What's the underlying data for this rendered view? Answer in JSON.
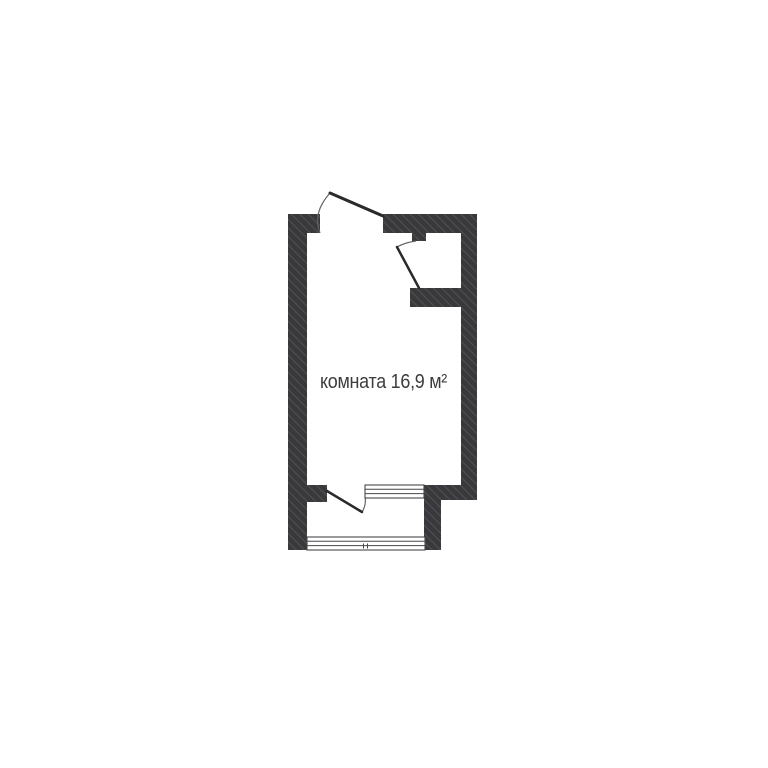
{
  "canvas": {
    "width": 768,
    "height": 768,
    "background": "#ffffff"
  },
  "floorplan": {
    "room": {
      "label": "комната 16,9 м²",
      "name": "комната",
      "area_m2": "16,9",
      "area_unit": "м²"
    },
    "features": {
      "entry_door": "top wall, opens outward, hinge right",
      "niche_door": "top-right niche, hinge bottom",
      "balcony_door": "bottom divider, opens into balcony",
      "room_balcony_window": "bottom divider right",
      "balcony_window": "bottom outer wall"
    },
    "colors": {
      "wall": "#39393c",
      "wall_hatch": "#4f4f54",
      "door_line": "#2a2a2c",
      "arc_line": "#626265",
      "window_line": "#47474a",
      "label_text": "#3d3d3f"
    }
  }
}
